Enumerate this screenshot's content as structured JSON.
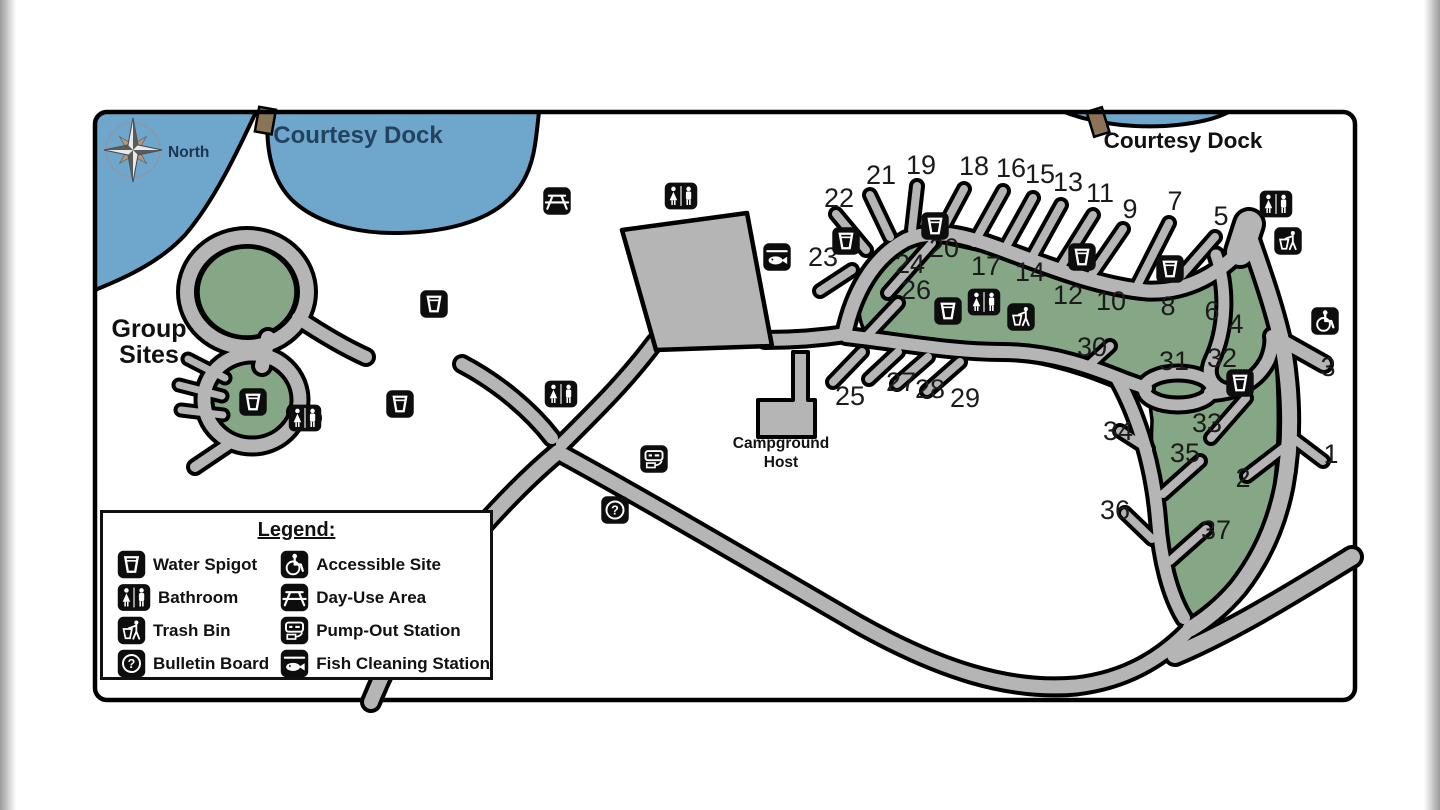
{
  "map": {
    "colors": {
      "water": "#6ea7cb",
      "green": "#86a785",
      "road": "#b5b5b5",
      "dock": "#8b7355",
      "border": "#000000",
      "site_text": "#1b1b1b",
      "water_label_text": "#23425f",
      "north_text": "#1d3450"
    },
    "labels": {
      "north": "North",
      "courtesy_dock_left": "Courtesy Dock",
      "courtesy_dock_right": "Courtesy Dock",
      "group_sites_line1": "Group",
      "group_sites_line2": "Sites",
      "campground_host_line1": "Campground",
      "campground_host_line2": "Host"
    },
    "sites": [
      {
        "n": "1",
        "x": 1331,
        "y": 463
      },
      {
        "n": "2",
        "x": 1243,
        "y": 487
      },
      {
        "n": "3",
        "x": 1328,
        "y": 376
      },
      {
        "n": "4",
        "x": 1236,
        "y": 333
      },
      {
        "n": "5",
        "x": 1221,
        "y": 225
      },
      {
        "n": "6",
        "x": 1212,
        "y": 320
      },
      {
        "n": "7",
        "x": 1175,
        "y": 210
      },
      {
        "n": "8",
        "x": 1168,
        "y": 315
      },
      {
        "n": "9",
        "x": 1130,
        "y": 218
      },
      {
        "n": "10",
        "x": 1111,
        "y": 310
      },
      {
        "n": "11",
        "x": 1100,
        "y": 202
      },
      {
        "n": "12",
        "x": 1068,
        "y": 304
      },
      {
        "n": "13",
        "x": 1068,
        "y": 191
      },
      {
        "n": "14",
        "x": 1030,
        "y": 281
      },
      {
        "n": "15",
        "x": 1040,
        "y": 183
      },
      {
        "n": "16",
        "x": 1011,
        "y": 177
      },
      {
        "n": "17",
        "x": 986,
        "y": 275
      },
      {
        "n": "18",
        "x": 974,
        "y": 175
      },
      {
        "n": "19",
        "x": 921,
        "y": 174
      },
      {
        "n": "20",
        "x": 944,
        "y": 257
      },
      {
        "n": "21",
        "x": 881,
        "y": 184
      },
      {
        "n": "22",
        "x": 839,
        "y": 207
      },
      {
        "n": "23",
        "x": 823,
        "y": 266
      },
      {
        "n": "24",
        "x": 910,
        "y": 273
      },
      {
        "n": "25",
        "x": 850,
        "y": 405
      },
      {
        "n": "26",
        "x": 916,
        "y": 299
      },
      {
        "n": "27",
        "x": 901,
        "y": 391
      },
      {
        "n": "28",
        "x": 930,
        "y": 398
      },
      {
        "n": "29",
        "x": 965,
        "y": 407
      },
      {
        "n": "30",
        "x": 1092,
        "y": 356
      },
      {
        "n": "31",
        "x": 1174,
        "y": 370
      },
      {
        "n": "32",
        "x": 1222,
        "y": 367
      },
      {
        "n": "33",
        "x": 1207,
        "y": 432
      },
      {
        "n": "34",
        "x": 1118,
        "y": 440
      },
      {
        "n": "35",
        "x": 1185,
        "y": 462
      },
      {
        "n": "36",
        "x": 1115,
        "y": 519
      },
      {
        "n": "37",
        "x": 1216,
        "y": 539
      }
    ],
    "icons": [
      {
        "type": "day-use-area",
        "x": 557,
        "y": 201
      },
      {
        "type": "bathroom",
        "x": 681,
        "y": 196
      },
      {
        "type": "fish-cleaning-station",
        "x": 777,
        "y": 257
      },
      {
        "type": "water-spigot",
        "x": 434,
        "y": 304
      },
      {
        "type": "water-spigot",
        "x": 400,
        "y": 404
      },
      {
        "type": "bathroom",
        "x": 561,
        "y": 394
      },
      {
        "type": "water-spigot",
        "x": 253,
        "y": 402
      },
      {
        "type": "bathroom",
        "x": 305,
        "y": 418
      },
      {
        "type": "pump-out-station",
        "x": 654,
        "y": 459
      },
      {
        "type": "bulletin-board",
        "x": 615,
        "y": 510
      },
      {
        "type": "water-spigot",
        "x": 846,
        "y": 241
      },
      {
        "type": "water-spigot",
        "x": 935,
        "y": 226
      },
      {
        "type": "water-spigot",
        "x": 1082,
        "y": 257
      },
      {
        "type": "water-spigot",
        "x": 1170,
        "y": 269
      },
      {
        "type": "water-spigot",
        "x": 948,
        "y": 311
      },
      {
        "type": "bathroom",
        "x": 984,
        "y": 302
      },
      {
        "type": "trash-bin",
        "x": 1021,
        "y": 317
      },
      {
        "type": "bathroom",
        "x": 1276,
        "y": 204
      },
      {
        "type": "trash-bin",
        "x": 1288,
        "y": 241
      },
      {
        "type": "accessible-site",
        "x": 1325,
        "y": 321
      },
      {
        "type": "water-spigot",
        "x": 1240,
        "y": 383
      }
    ]
  },
  "legend": {
    "title": "Legend:",
    "items": [
      {
        "icon": "water-spigot",
        "label": "Water Spigot"
      },
      {
        "icon": "bathroom",
        "label": "Bathroom"
      },
      {
        "icon": "trash-bin",
        "label": "Trash Bin"
      },
      {
        "icon": "bulletin-board",
        "label": "Bulletin Board"
      },
      {
        "icon": "accessible-site",
        "label": "Accessible Site"
      },
      {
        "icon": "day-use-area",
        "label": "Day-Use Area"
      },
      {
        "icon": "pump-out-station",
        "label": "Pump-Out Station"
      },
      {
        "icon": "fish-cleaning-station",
        "label": "Fish Cleaning Station"
      }
    ]
  }
}
